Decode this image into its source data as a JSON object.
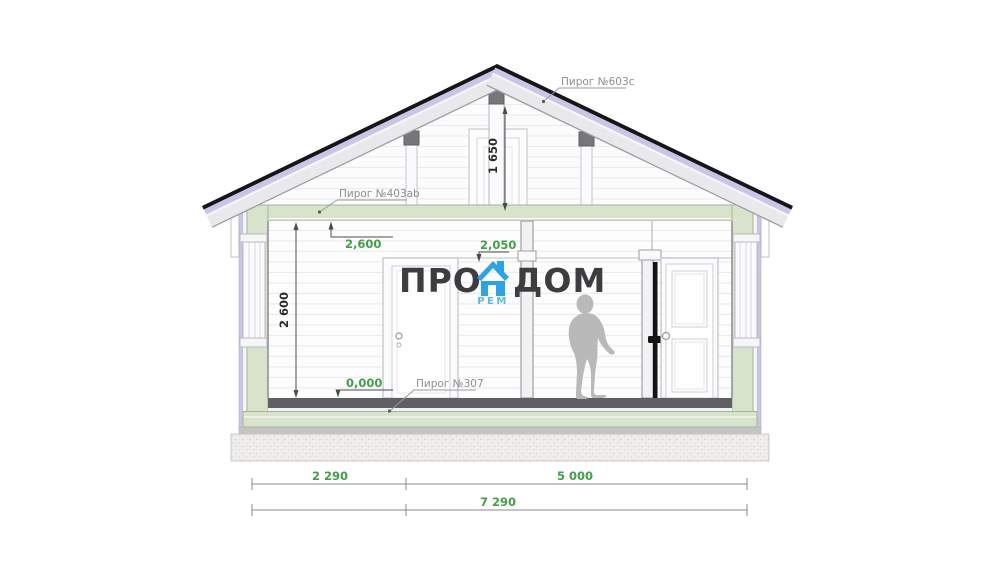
{
  "drawing": {
    "type": "house cross-section",
    "layer_labels": {
      "roof": "Пирог №603с",
      "ceiling": "Пирог №403ab",
      "floor": "Пирог №307"
    },
    "level_marks": {
      "ceiling_height": "2,600",
      "door_top": "2,050",
      "floor_zero": "0,000"
    },
    "vertical_dimensions": {
      "attic_height": "1 650",
      "room_height": "2 600"
    },
    "horizontal_dimensions": {
      "left_span": "2 290",
      "right_span": "5 000",
      "total_span": "7 290"
    }
  },
  "watermark": {
    "text_left": "ПРО",
    "text_right": "ДОМ",
    "text_sub": "РЕМ",
    "icon": "house-icon",
    "text_color": "#3d3d40",
    "accent_color": "#2aa4e9"
  },
  "colors": {
    "dimension_green": "#3fa044",
    "label_gray": "#8e8e8e",
    "wall_green": "#d7e4cb",
    "membrane_lavender": "#c9c5e8",
    "roof_black": "#161616",
    "floor_dark": "#606064"
  }
}
